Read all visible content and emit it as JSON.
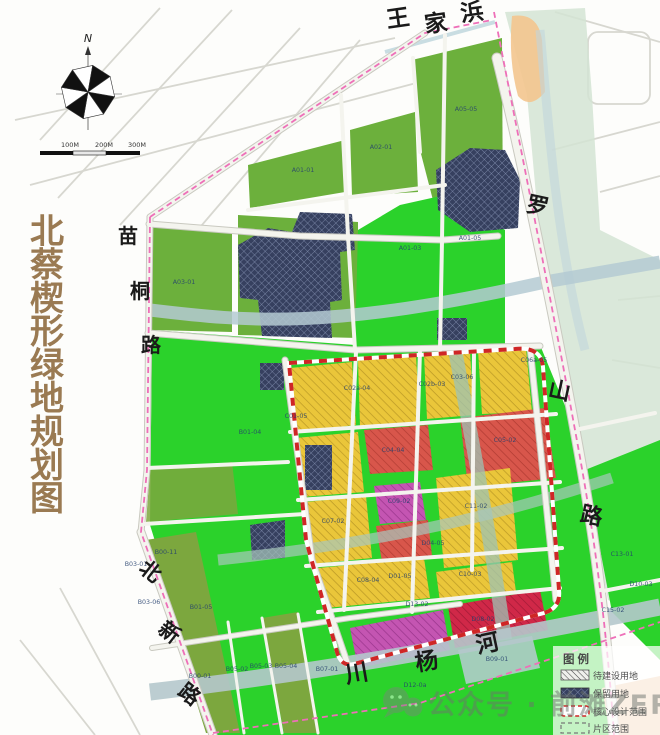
{
  "title": {
    "text": "北蔡楔形绿地规划图"
  },
  "compass": {
    "n": "N"
  },
  "scale_bar": {
    "labels": [
      "100M",
      "200M",
      "300M"
    ]
  },
  "legend": {
    "header": "图例",
    "items": [
      {
        "label": "待建设用地",
        "swatch": "grey-diagonal-hatch"
      },
      {
        "label": "保留用地",
        "swatch": "dark-cross-hatch"
      },
      {
        "label": "核心设计范围",
        "swatch": "red-white-dash-outline"
      },
      {
        "label": "片区范围",
        "swatch": "grey-dash-outline"
      }
    ]
  },
  "watermark": {
    "icon": "wechat-icon",
    "text": "公众号 · 前滩ZERO"
  },
  "map": {
    "road_labels": [
      {
        "name": "wangjiabang",
        "text": "王家浜",
        "chars": [
          [
            "王",
            399,
            26,
            -8,
            23
          ],
          [
            "家",
            437,
            31,
            -8,
            23
          ],
          [
            "浜",
            473,
            20,
            -8,
            23
          ]
        ]
      },
      {
        "name": "luoshan-road",
        "text": "罗山路",
        "chars": [
          [
            "罗",
            536,
            213,
            12,
            22
          ],
          [
            "山",
            558,
            398,
            12,
            22
          ],
          [
            "路",
            590,
            523,
            12,
            22
          ]
        ]
      },
      {
        "name": "miaotong-road",
        "text": "苗桐路",
        "chars": [
          [
            "苗",
            128,
            243,
            0,
            20
          ],
          [
            "桐",
            140,
            298,
            0,
            20
          ],
          [
            "路",
            151,
            352,
            0,
            20
          ]
        ]
      },
      {
        "name": "beixin-road",
        "text": "北新路",
        "chars": [
          [
            "北",
            146,
            577,
            38,
            21
          ],
          [
            "新",
            165,
            638,
            38,
            21
          ],
          [
            "路",
            185,
            700,
            38,
            21
          ]
        ]
      },
      {
        "name": "chuanyang-river",
        "text": "川杨河",
        "chars": [
          [
            "川",
            358,
            681,
            -10,
            23
          ],
          [
            "杨",
            428,
            669,
            -10,
            23
          ],
          [
            "河",
            489,
            651,
            -12,
            23
          ]
        ]
      }
    ],
    "parcel_codes": [
      [
        "A03-01",
        184,
        284
      ],
      [
        "A01-01",
        303,
        172
      ],
      [
        "A02-01",
        381,
        149
      ],
      [
        "A05-05",
        466,
        111
      ],
      [
        "A01-03",
        410,
        250
      ],
      [
        "A01-05",
        470,
        240
      ],
      [
        "B01-04",
        250,
        434
      ],
      [
        "C01-05",
        296,
        418
      ],
      [
        "C02a-04",
        357,
        390
      ],
      [
        "C02b-03",
        432,
        386
      ],
      [
        "C03-06",
        462,
        379
      ],
      [
        "C05-02",
        505,
        442
      ],
      [
        "C04-04",
        393,
        452
      ],
      [
        "C09-02",
        399,
        503
      ],
      [
        "C11-02",
        476,
        508
      ],
      [
        "C07-02",
        333,
        523
      ],
      [
        "C08-04",
        368,
        582
      ],
      [
        "D01-05",
        400,
        578
      ],
      [
        "D04-05",
        433,
        545
      ],
      [
        "C10-03",
        470,
        576
      ],
      [
        "B03-01",
        136,
        566
      ],
      [
        "B00-11",
        166,
        554
      ],
      [
        "B03-06",
        149,
        604
      ],
      [
        "B01-05",
        201,
        609
      ],
      [
        "B00-01",
        200,
        678
      ],
      [
        "B05-02",
        237,
        671
      ],
      [
        "B05-03",
        261,
        668
      ],
      [
        "B05-04",
        286,
        668
      ],
      [
        "B07-01",
        327,
        671
      ],
      [
        "B09-01",
        497,
        661
      ],
      [
        "D12-0a",
        415,
        687
      ],
      [
        "D13-02",
        417,
        606
      ],
      [
        "D08-02",
        483,
        621
      ],
      [
        "C06a-05",
        534,
        362
      ],
      [
        "C13-01",
        622,
        556
      ],
      [
        "D10-03",
        641,
        586
      ],
      [
        "C15-02",
        613,
        612
      ]
    ]
  },
  "colors": {
    "title": "#9a7a52",
    "bright_green": "#2bd22b",
    "medium_green": "#6cb03c",
    "olive_green": "#7ca73e",
    "yellow_parcel": "#eac63a",
    "red_parcel": "#d8564b",
    "magenta_parcel": "#c455b2",
    "crimson_parcel": "#d02848",
    "retained_navy": "#36405f",
    "river": "#b4cad2",
    "boundary_pink": "#ee6fb8",
    "core_red": "#cf2626",
    "orange_patch": "#f3c58e"
  }
}
